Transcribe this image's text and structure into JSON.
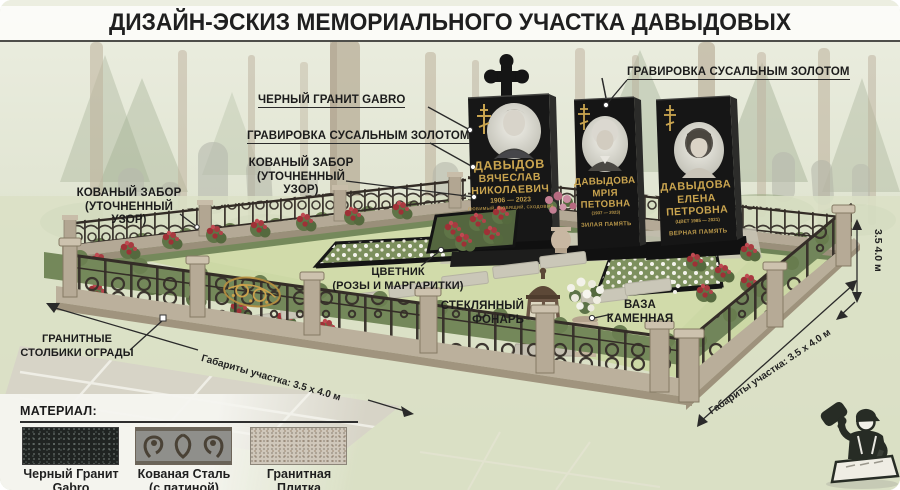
{
  "title": "ДИЗАЙН-ЭСКИЗ МЕМОРИАЛЬНОГО УЧАСТКА ДАВЫДОВЫХ",
  "callouts": {
    "black_granite": "ЧЕРНЫЙ ГРАНИТ GABRO",
    "gilding": "ГРАВИРОВКА СУСАЛЬНЫМ ЗОЛОТОМ",
    "fence_line1": "КОВАНЫЙ ЗАБОР",
    "fence_line2": "(УТОЧНЕННЫЙ УЗОР)",
    "flowerbed_line1": "ЦВЕТНИК",
    "flowerbed_line2": "(РОЗЫ И МАРГАРИТКИ)",
    "lantern_line1": "СТЕКЛЯННЫЙ",
    "lantern_line2": "ФОНАРЬ",
    "vase_line1": "ВАЗА",
    "vase_line2": "КАМЕННАЯ",
    "pillars_line1": "ГРАНИТНЫЕ",
    "pillars_line2": "СТОЛБИКИ ОГРАДЫ"
  },
  "dimensions": {
    "plot_size": "Габариты участка: 3.5 х 4.0 м",
    "height_mark": "3.5 4.0 м"
  },
  "monuments": [
    {
      "surname": "ДАВЫДОВ",
      "name": "ВЯЧЕСЛАВ",
      "patronymic": "НИКОЛАЕВИЧ",
      "dates": "1906 — 2023",
      "epitaph": "ЛЮБИМЫЙ, ЛЮБЯЩИЙ, СХОДОВИЯ"
    },
    {
      "surname": "ДАВЫДОВА",
      "name": "МРІЯ",
      "patronymic": "ПЕТОВНА",
      "dates": "(1937 — 2023)",
      "epitaph": "ЗИЛАЯ ПАМЯТЬ"
    },
    {
      "surname": "ДАВЫДОВА",
      "name": "ЕЛЕНА",
      "patronymic": "ПЕТРОВНА",
      "dates": "(ЦВЕТ 1985 — 2021)",
      "epitaph": "ВЕРНАЯ ПАМЯТЬ"
    }
  ],
  "materials": {
    "header": "МАТЕРИАЛ:",
    "items": [
      {
        "line1": "Черный Гранит",
        "line2": "Gabro"
      },
      {
        "line1": "Кованая Сталь",
        "line2": "(с патиной)"
      },
      {
        "line1": "Гранитная",
        "line2": "Плитка"
      }
    ]
  },
  "colors": {
    "gold_engraving": "#c9a44f",
    "granite_black": "#1a1a1a",
    "grass_green": "#ccd8a5",
    "wrought_iron": "#37302a",
    "granite_post": "#b6aa96"
  }
}
